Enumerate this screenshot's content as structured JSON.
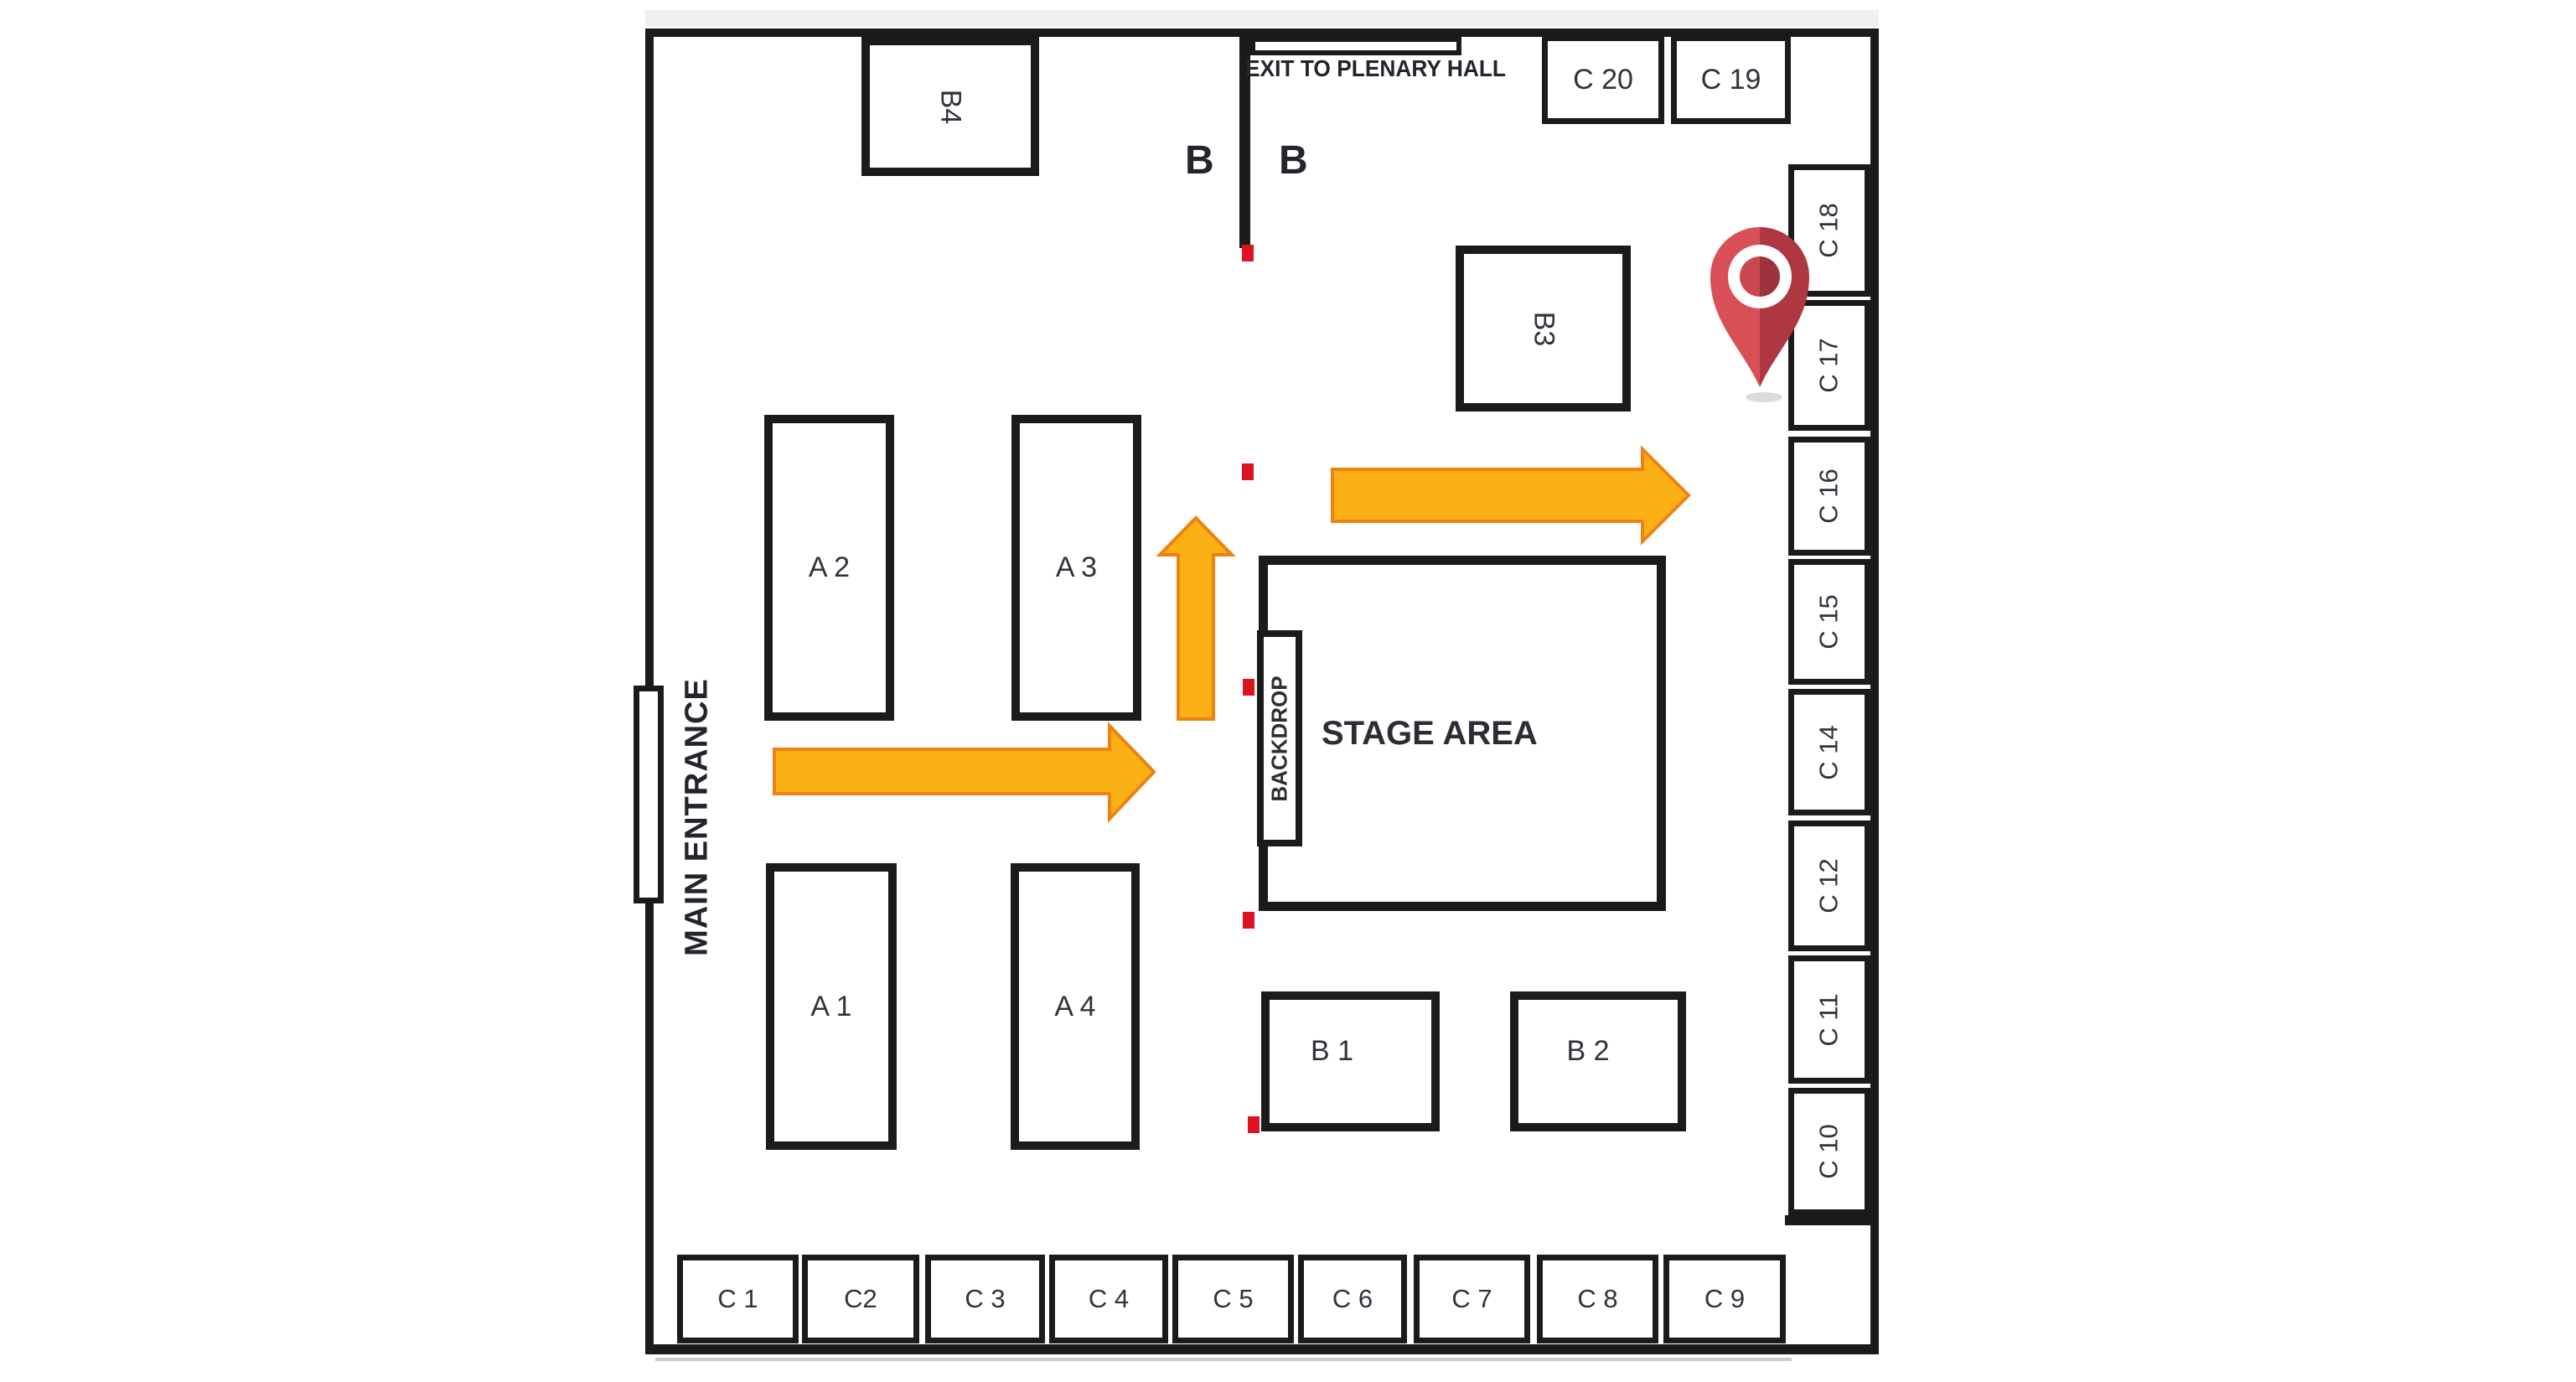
{
  "title": "Exhibition Hall Floor Plan",
  "labels": {
    "exit": "EXIT TO PLENARY HALL",
    "entrance": "MAIN ENTRANCE",
    "stage": "STAGE AREA",
    "backdrop": "BACKDROP",
    "zone_b_left": "B",
    "zone_b_right": "B"
  },
  "booths": {
    "a1": "A 1",
    "a2": "A 2",
    "a3": "A 3",
    "a4": "A 4",
    "b1": "B 1",
    "b2": "B 2",
    "b3": "B3",
    "b4": "B4",
    "c1": "C 1",
    "c2": "C2",
    "c3": "C 3",
    "c4": "C 4",
    "c5": "C 5",
    "c6": "C 6",
    "c7": "C 7",
    "c8": "C 8",
    "c9": "C 9",
    "c10": "C 10",
    "c11": "C 11",
    "c12": "C 12",
    "c14": "C 14",
    "c15": "C 15",
    "c16": "C 16",
    "c17": "C 17",
    "c18": "C 18",
    "c19": "C 19",
    "c20": "C 20"
  },
  "colors": {
    "wall": "#1b1b1b",
    "arrow_fill": "#FBB116",
    "arrow_stroke": "#EE8210",
    "marker_red": "#DE1321",
    "pin_light": "#D94F57",
    "pin_dark": "#AE3742",
    "pin_dot_light": "#CB4750",
    "pin_dot_dark": "#9C333D"
  }
}
